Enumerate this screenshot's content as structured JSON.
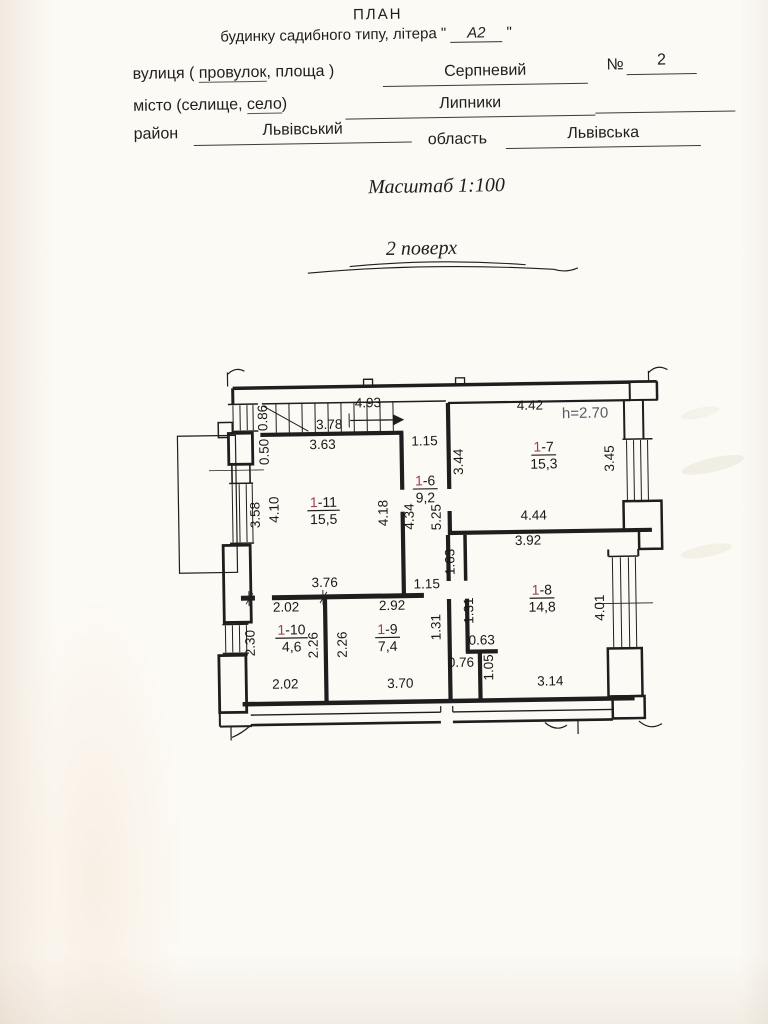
{
  "header": {
    "title": "ПЛАН",
    "subtitle_prefix": "будинку садибного типу, літера \" ",
    "subtitle_value": "А2",
    "subtitle_suffix": " \"",
    "fields": {
      "street_label_1": "вулиця ( ",
      "street_label_2": "провулок",
      "street_label_3": ", площа )",
      "street_value": "Серпневий",
      "number_label": "№",
      "number_value": "2",
      "city_label_1": "місто (селище, ",
      "city_label_2": "село",
      "city_label_3": ")",
      "city_value": "Липники",
      "district_label": "район",
      "district_value": "Львівський",
      "region_label": "область",
      "region_value": "Львівська"
    },
    "scale": "Масштаб 1:100",
    "floor": "2 поверх"
  },
  "plan": {
    "height_note": {
      "text": "h=2.70",
      "x": 585,
      "y": 421
    },
    "colors": {
      "room_number_accent": "#9c4348",
      "height_note": "#565a68",
      "ink": "#1e1e1e"
    },
    "rooms": [
      {
        "number_prefix": "1",
        "number_rest": "-11",
        "area": "15,5",
        "x": 322,
        "y": 506
      },
      {
        "number_prefix": "1",
        "number_rest": "-6",
        "area": "9,2",
        "x": 424,
        "y": 486
      },
      {
        "number_prefix": "1",
        "number_rest": "-7",
        "area": "15,3",
        "x": 543,
        "y": 454
      },
      {
        "number_prefix": "1",
        "number_rest": "-8",
        "area": "14,8",
        "x": 539,
        "y": 597
      },
      {
        "number_prefix": "1",
        "number_rest": "-9",
        "area": "7,4",
        "x": 384,
        "y": 634
      },
      {
        "number_prefix": "1",
        "number_rest": "-10",
        "area": "4,6",
        "x": 288,
        "y": 633
      }
    ],
    "dimensions": [
      {
        "text": "0.86",
        "x": 267,
        "y": 416,
        "rot": -90
      },
      {
        "text": "3.78",
        "x": 329,
        "y": 428,
        "rot": 0
      },
      {
        "text": "4.93",
        "x": 368,
        "y": 407,
        "rot": 0
      },
      {
        "text": "3.63",
        "x": 322,
        "y": 448,
        "rot": 0
      },
      {
        "text": "1.15",
        "x": 424,
        "y": 446,
        "rot": 0
      },
      {
        "text": "0.50",
        "x": 268,
        "y": 450,
        "rot": -90
      },
      {
        "text": "3.58",
        "x": 258,
        "y": 513,
        "rot": -90
      },
      {
        "text": "4.10",
        "x": 277,
        "y": 508,
        "rot": -90
      },
      {
        "text": "4.18",
        "x": 386,
        "y": 513,
        "rot": -90
      },
      {
        "text": "4.34",
        "x": 412,
        "y": 517,
        "rot": -90
      },
      {
        "text": "5.25",
        "x": 439,
        "y": 518,
        "rot": -90
      },
      {
        "text": "3.44",
        "x": 462,
        "y": 463,
        "rot": -90
      },
      {
        "text": "4.42",
        "x": 530,
        "y": 412,
        "rot": 0
      },
      {
        "text": "3.45",
        "x": 613,
        "y": 462,
        "rot": -90
      },
      {
        "text": "4.44",
        "x": 532,
        "y": 522,
        "rot": 0
      },
      {
        "text": "3.92",
        "x": 526,
        "y": 547,
        "rot": 0
      },
      {
        "text": "1.63",
        "x": 452,
        "y": 563,
        "rot": -90
      },
      {
        "text": "1.15",
        "x": 424,
        "y": 589,
        "rot": 0
      },
      {
        "text": "3.76",
        "x": 322,
        "y": 586,
        "rot": 0
      },
      {
        "text": "2.02",
        "x": 283,
        "y": 610,
        "rot": 0
      },
      {
        "text": "2.92",
        "x": 389,
        "y": 610,
        "rot": 0
      },
      {
        "text": "1.31",
        "x": 437,
        "y": 628,
        "rot": -90
      },
      {
        "text": "1.31",
        "x": 470,
        "y": 612,
        "rot": -90
      },
      {
        "text": "2.30",
        "x": 251,
        "y": 641,
        "rot": -90
      },
      {
        "text": "2.26",
        "x": 314,
        "y": 644,
        "rot": -90
      },
      {
        "text": "2.26",
        "x": 343,
        "y": 644,
        "rot": -90
      },
      {
        "text": "0.63",
        "x": 478,
        "y": 646,
        "rot": 0
      },
      {
        "text": "0.76",
        "x": 457,
        "y": 668,
        "rot": 0
      },
      {
        "text": "1.05",
        "x": 489,
        "y": 669,
        "rot": -90
      },
      {
        "text": "2.02",
        "x": 281,
        "y": 687,
        "rot": 0
      },
      {
        "text": "3.70",
        "x": 396,
        "y": 688,
        "rot": 0
      },
      {
        "text": "3.14",
        "x": 546,
        "y": 688,
        "rot": 0
      },
      {
        "text": "4.01",
        "x": 601,
        "y": 611,
        "rot": -90
      }
    ]
  }
}
